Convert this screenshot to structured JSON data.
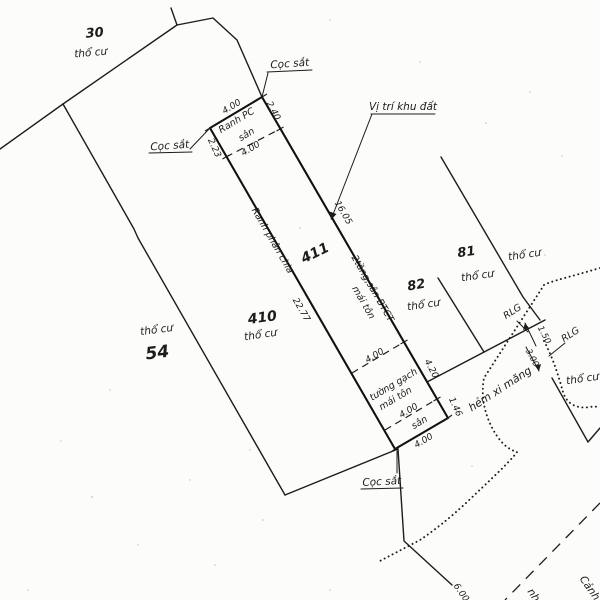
{
  "parcels": {
    "p30": {
      "number": "30",
      "landuse": "thổ cư"
    },
    "p54": {
      "number": "54",
      "landuse": "thổ cư"
    },
    "p410": {
      "number": "410",
      "landuse": "thổ cư"
    },
    "p411": {
      "number": "411"
    },
    "p82": {
      "number": "82",
      "landuse": "thổ cư"
    },
    "p81": {
      "number": "81",
      "landuse": "thổ cư"
    },
    "neighbor_right": {
      "landuse": "thổ cư"
    },
    "neighbor_southeast": {
      "landuse": "thổ cư"
    }
  },
  "labels": {
    "site_location": "Vị trí khu đất",
    "iron_stake": "Cọc sắt",
    "boundary_pc": "Ranh PC",
    "division_boundary": "Ranh phân chia",
    "yard": "sân",
    "building_line1": "2tầng,sân BTCT",
    "building_line2": "mái tôn",
    "wall_line1": "tường gạch",
    "wall_line2": "mái tôn",
    "alley": "hẻm xi măng",
    "road_boundary": "RLG",
    "edge_fragment_nh": "nh",
    "edge_fragment_canh": "Cảnh"
  },
  "dimensions": {
    "top_width": "4.00",
    "left_upper": "2.23",
    "right_upper": "2.40",
    "yard_top_width": "4.00",
    "right_main": "16.05",
    "left_main": "22.77",
    "wall_top_width": "4.00",
    "right_lower": "4.20",
    "yard_bottom_width": "4.00",
    "right_bottom": "1.46",
    "bottom_width": "4.00",
    "rlg_offset": "1.50",
    "alley_width": "3.00",
    "edge_fragment_dim": "6.00"
  },
  "colors": {
    "ink": "#1c1c1c",
    "paper": "#fcfcfa"
  }
}
